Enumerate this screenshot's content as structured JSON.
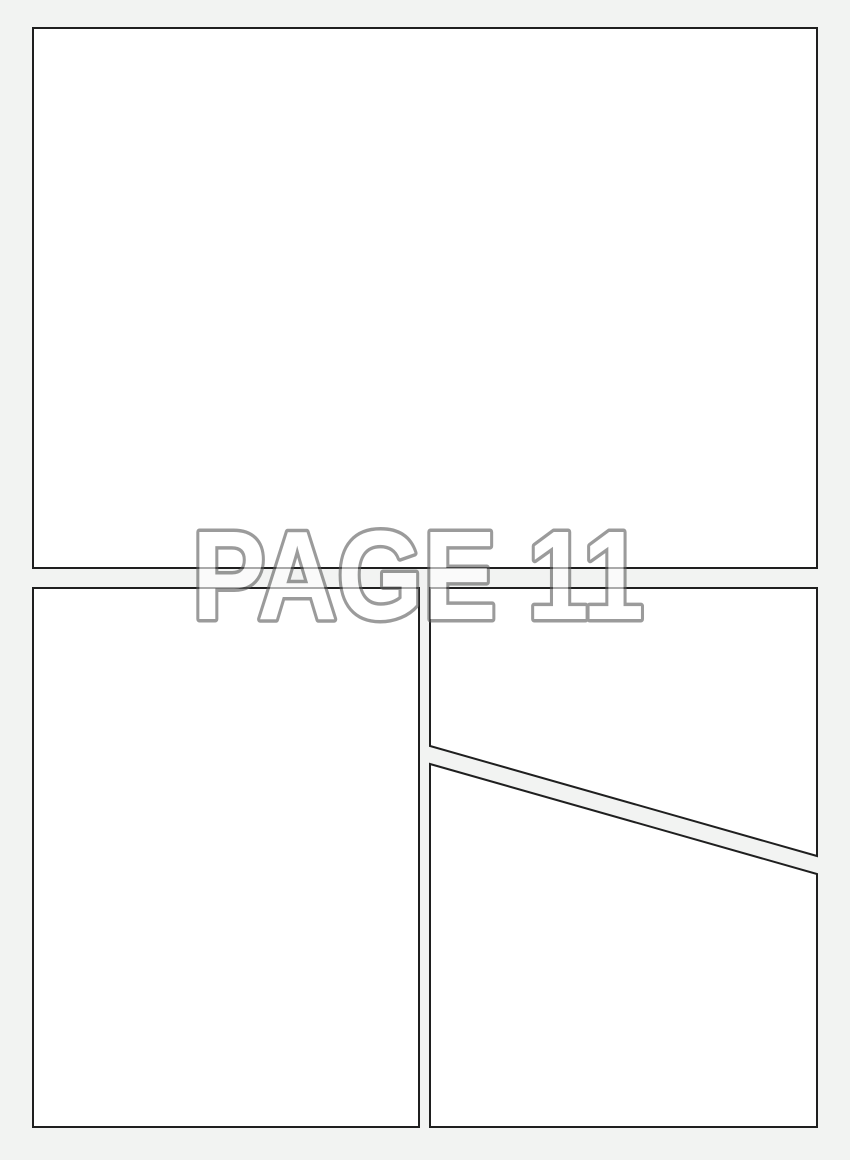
{
  "page": {
    "label": "PAGE 11",
    "background_color": "#f2f3f2"
  },
  "panels": {
    "fill": "#ffffff",
    "border_color": "#1f1f1f"
  },
  "label_style": {
    "fill": "#ffffff",
    "outline_color": "#5f5f5f"
  }
}
